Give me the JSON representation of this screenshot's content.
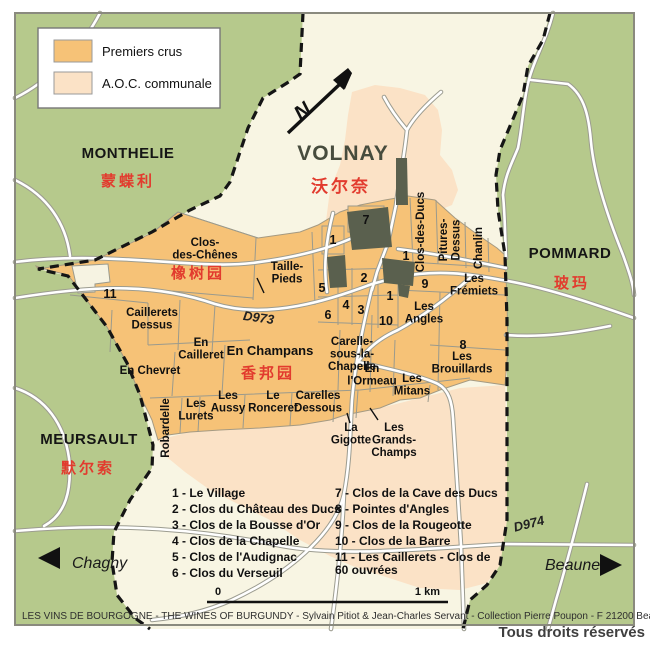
{
  "colors": {
    "premiers_crus": "#f6c277",
    "aoc_communale": "#fbe2c6",
    "surround_green": "#b6c98c",
    "commune_cream": "#f8f5e3",
    "village_dark": "#5a604e",
    "chinese_red": "#e23b2e"
  },
  "legend": {
    "items": [
      {
        "label": "Premiers crus",
        "color": "#f6c277"
      },
      {
        "label": "A.O.C. communale",
        "color": "#fbe2c6"
      }
    ]
  },
  "north_arrow": "N",
  "communes": [
    {
      "name": "MONTHELIE",
      "zh": "蒙蝶利"
    },
    {
      "name": "VOLNAY",
      "zh": "沃尔奈"
    },
    {
      "name": "POMMARD",
      "zh": "玻玛"
    },
    {
      "name": "MEURSAULT",
      "zh": "默尔索"
    }
  ],
  "vineyards": [
    {
      "name": "Clos-\ndes-Chênes",
      "zh": "橡树园"
    },
    {
      "name": "Taille-\nPieds"
    },
    {
      "name": "Caillerets\nDessus"
    },
    {
      "name": "En\nCailleret"
    },
    {
      "name": "En Chevret"
    },
    {
      "name": "En Champans",
      "zh": "香邦园"
    },
    {
      "name": "Carelle-\nsous-la-\nChapelle"
    },
    {
      "name": "En\nl'Ormeau"
    },
    {
      "name": "Les\nMitans"
    },
    {
      "name": "Les\nBrouillards"
    },
    {
      "name": "Les\nFrémiets"
    },
    {
      "name": "Les\nAngles"
    },
    {
      "name": "Les\nAussy"
    },
    {
      "name": "Le\nRonceret"
    },
    {
      "name": "Carelles\nDessous"
    },
    {
      "name": "Les\nLurets"
    },
    {
      "name": "Robardelle"
    },
    {
      "name": "La\nGigotte"
    },
    {
      "name": "Les\nGrands-\nChamps"
    },
    {
      "name": "Clos-des-Ducs"
    },
    {
      "name": "Pitures-\nDessus"
    },
    {
      "name": "Chanlin"
    }
  ],
  "plot_numbers": [
    "1",
    "2",
    "3",
    "4",
    "5",
    "6",
    "7",
    "8",
    "9",
    "10",
    "11"
  ],
  "index": [
    "1 - Le Village",
    "2 - Clos du Château des Ducs",
    "3 - Clos de la Bousse d'Or",
    "4 - Clos de la Chapelle",
    "5 - Clos de l'Audignac",
    "6 - Clos du Verseuil",
    "7 - Clos de la Cave des Ducs",
    "8 - Pointes d'Angles",
    "9 - Clos de la Rougeotte",
    "10 - Clos de la Barre",
    "11 - Les Caillerets - Clos de\n60 ouvrées"
  ],
  "roads": {
    "d973": "D973",
    "d974": "D974"
  },
  "directions": {
    "west": "Chagny",
    "east": "Beaune"
  },
  "scale_bar": {
    "start": "0",
    "end": "1 km"
  },
  "credit": "LES VINS DE BOURGOGNE - THE WINES OF BURGUNDY - Sylvain Pitiot & Jean-Charles Servant - Collection Pierre Poupon - F 21200 Beaune-Vignoles",
  "rights": "Tous droits réservés"
}
